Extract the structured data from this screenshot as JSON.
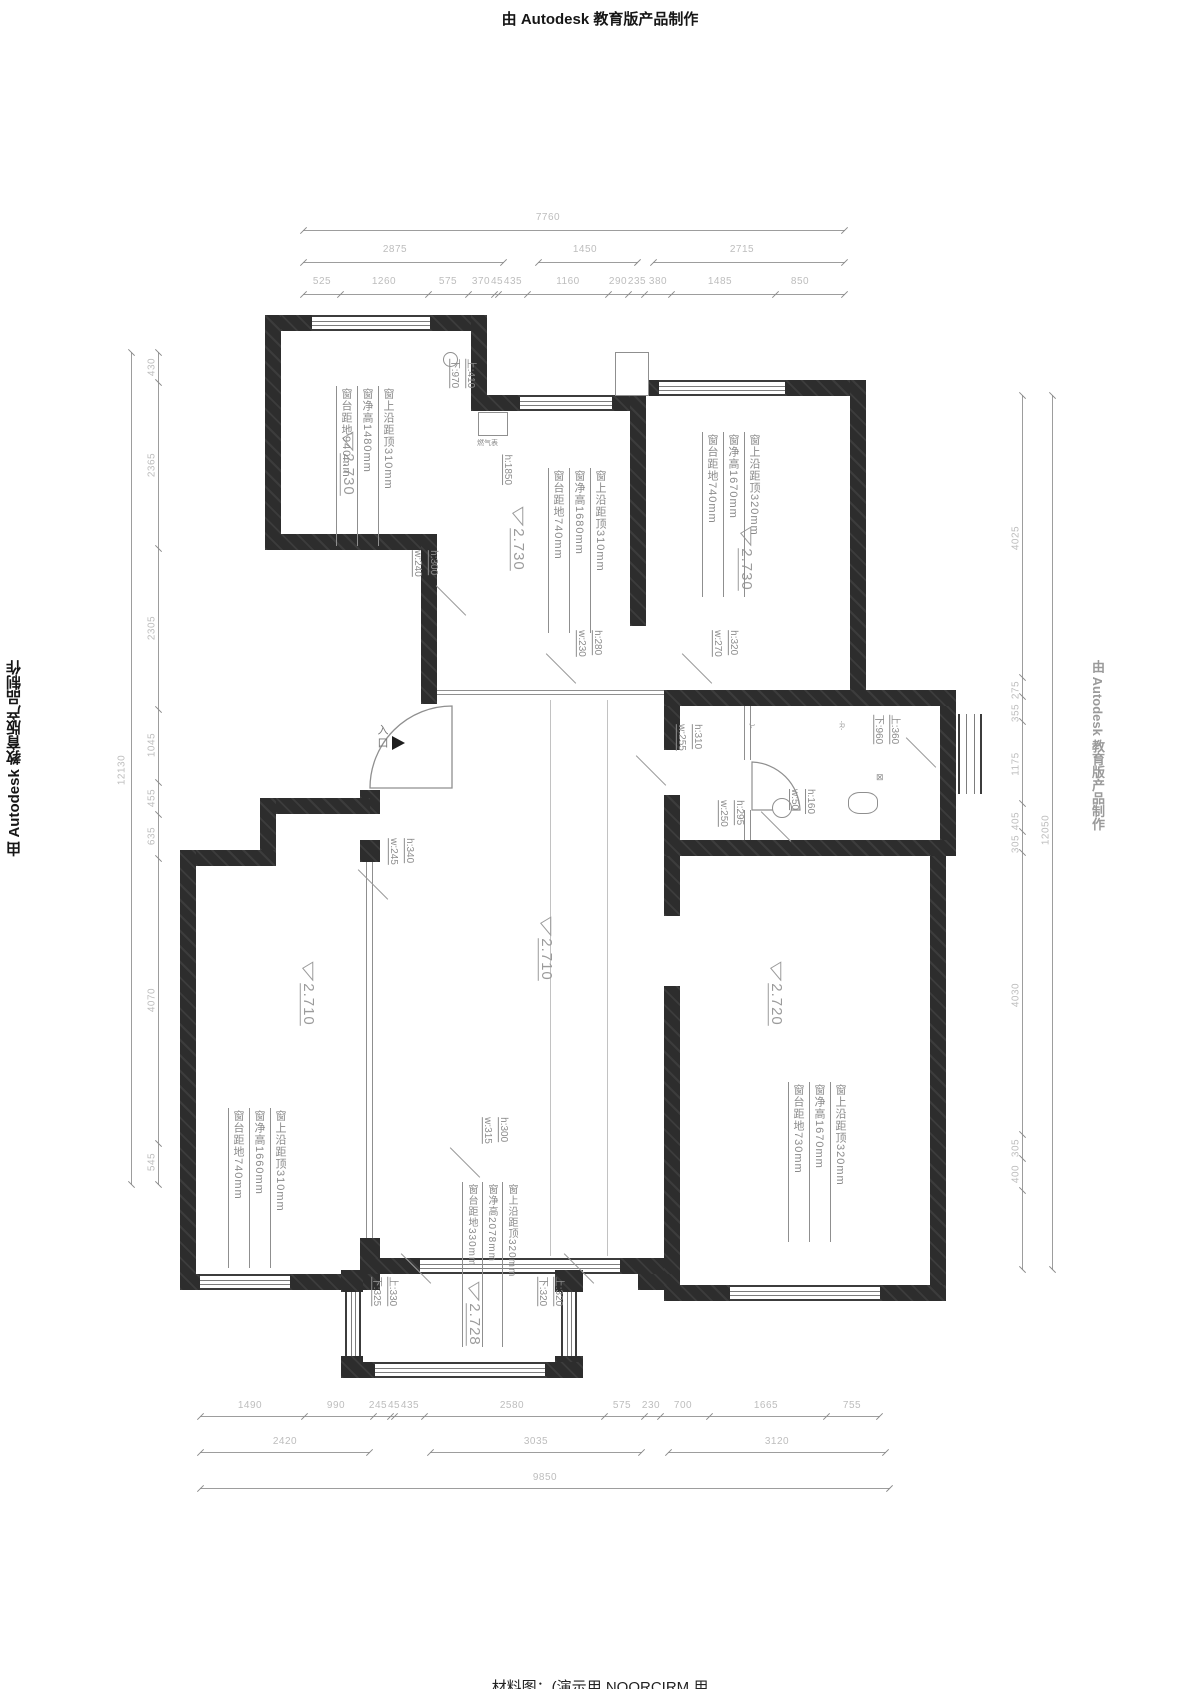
{
  "watermarks": {
    "autodesk": "由 Autodesk 教育版产品制作",
    "bottom_caption": "材料图：(演示用 NOORCIRM 用"
  },
  "levels": {
    "top_left_room": "2.730",
    "kitchen": "2.730",
    "top_right_room": "2.730",
    "living": "2.710",
    "bottom_left_room": "2.710",
    "bottom_right_room": "2.720",
    "balcony": "2.728"
  },
  "window_notes": {
    "top_left_room": [
      "窗上沿距顶310mm",
      "窗净高1480mm",
      "窗台距地940mm"
    ],
    "kitchen": [
      "窗上沿距顶310mm",
      "窗净高1680mm",
      "窗台距地740mm"
    ],
    "top_right_room": [
      "窗上沿距顶320mm",
      "窗净高1670mm",
      "窗台距地740mm"
    ],
    "bottom_left_room": [
      "窗上沿距顶310mm",
      "窗净高1660mm",
      "窗台距地740mm"
    ],
    "bottom_right_room": [
      "窗上沿距顶320mm",
      "窗净高1670mm",
      "窗台距地730mm"
    ],
    "balcony": [
      "窗上沿距顶320mm",
      "窗净高2078mm",
      "窗台距地330mm"
    ]
  },
  "openings": {
    "o1": "h:300\nw:240",
    "o2": "h:1850",
    "o3": "h:280\nw:230",
    "o4": "h:320\nw:270",
    "o5": "h:310\nw:255",
    "o6": "h:160\nw:50",
    "o7": "h:295\nw:250",
    "o8": "h:340\nw:245",
    "o9": "h:300\nw:315",
    "kitchen_updown": "上:410\n下:970",
    "bath_updown": "上:360\n下:960",
    "balcony_left": "上:330\n下:325",
    "balcony_right": "上:320\n下:320"
  },
  "labels": {
    "entrance": "入口",
    "gas_meter": "燃气表",
    "code_j": "J-",
    "code_r": "-R-",
    "valve": "⊠"
  },
  "dims": {
    "top": {
      "total": "7760",
      "row2": [
        "2875",
        "1450",
        "2715"
      ],
      "row3": [
        "525",
        "1260",
        "575",
        "370",
        "45",
        "435",
        "1160",
        "290",
        "235",
        "380",
        "1485",
        "850"
      ]
    },
    "bottom": {
      "row1": [
        "1490",
        "990",
        "245",
        "45",
        "435",
        "2580",
        "575",
        "230",
        "700",
        "1665",
        "755"
      ],
      "row2": [
        "2420",
        "3035",
        "3120"
      ],
      "total": "9850"
    },
    "left": {
      "total": "12130",
      "segs": [
        "430",
        "2365",
        "2305",
        "1045",
        "455",
        "635",
        "4070",
        "545"
      ]
    },
    "right": {
      "total": "12050",
      "segs": [
        "4025",
        "275",
        "355",
        "1175",
        "405",
        "305",
        "4030",
        "305",
        "400"
      ]
    }
  }
}
